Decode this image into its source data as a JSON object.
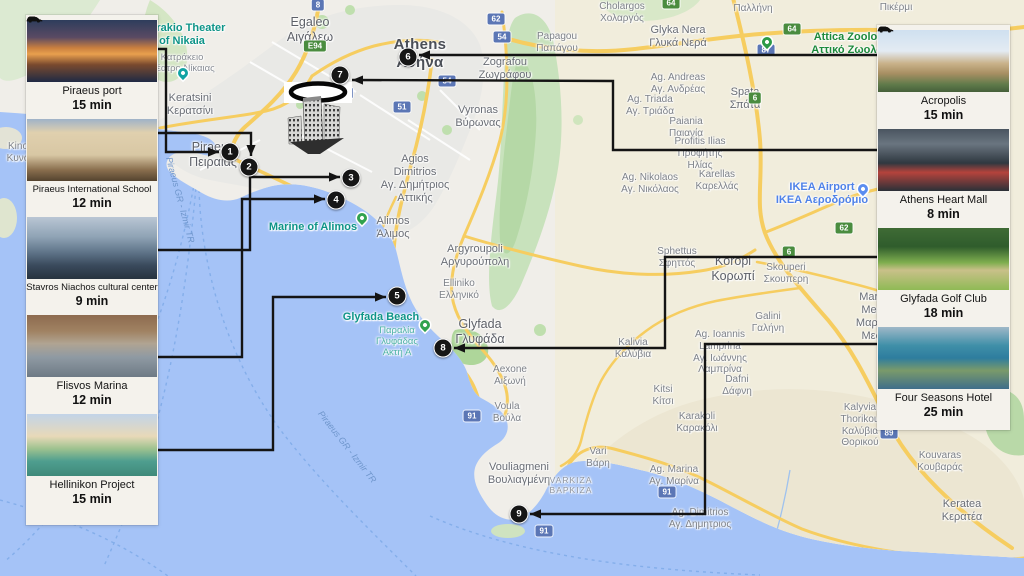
{
  "accent_colors": {
    "sea": "#a5c3f7",
    "land": "#f0eee9",
    "marker_bg": "#161616",
    "badge_blue": "#5b76b5",
    "badge_green": "#4a8c3f",
    "poi_teal": "#0e9488",
    "poi_green": "#1d8a3c",
    "poi_blue": "#4f82e8",
    "connector": "#141414"
  },
  "left_panel": {
    "items": [
      {
        "title": "Piraeus port",
        "time": "15 min",
        "img": "port"
      },
      {
        "title": "Piraeus International School",
        "time": "12 min",
        "img": "school"
      },
      {
        "title": "Stavros Niachos cultural center",
        "time": "9 min",
        "img": "stavros"
      },
      {
        "title": "Flisvos Marina",
        "time": "12 min",
        "img": "flisvos"
      },
      {
        "title": "Hellinikon Project",
        "time": "15 min",
        "img": "hellinikon"
      }
    ]
  },
  "right_panel": {
    "items": [
      {
        "title": "Acropolis",
        "time": "15 min",
        "img": "acropolis"
      },
      {
        "title": "Athens Heart Mall",
        "time": "8 min",
        "img": "mall"
      },
      {
        "title": "Glyfada Golf Club",
        "time": "18 min",
        "img": "golf"
      },
      {
        "title": "Four Seasons Hotel",
        "time": "25 min",
        "img": "fourseasons"
      }
    ]
  },
  "map": {
    "labels": [
      {
        "x": 310,
        "y": 15,
        "s": "md",
        "lines": [
          "Egaleo",
          "Αιγάλεω"
        ]
      },
      {
        "x": 420,
        "y": 36,
        "s": "lg",
        "lines": [
          "Athens",
          "Αθήνα"
        ]
      },
      {
        "x": 190,
        "y": 92,
        "s": "sm",
        "lines": [
          "Keratsini",
          "Κερατσίνι"
        ]
      },
      {
        "x": 213,
        "y": 140,
        "s": "md",
        "lines": [
          "Piraeus",
          "Πειραιάς"
        ]
      },
      {
        "x": 478,
        "y": 104,
        "s": "sm",
        "lines": [
          "Vyronas",
          "Βύρωνας"
        ]
      },
      {
        "x": 505,
        "y": 56,
        "s": "sm",
        "lines": [
          "Zografou",
          "Ζωγράφου"
        ]
      },
      {
        "x": 557,
        "y": 31,
        "s": "xs",
        "lines": [
          "Papagou",
          "Παπάγου"
        ]
      },
      {
        "x": 622,
        "y": 1,
        "s": "xs",
        "lines": [
          "Cholargos",
          "Χολαργός"
        ]
      },
      {
        "x": 678,
        "y": 24,
        "s": "sm",
        "lines": [
          "Glyka Nera",
          "Γλυκά Νερά"
        ]
      },
      {
        "x": 753,
        "y": 3,
        "s": "xs",
        "lines": [
          "Παλλήνη"
        ]
      },
      {
        "x": 896,
        "y": 2,
        "s": "xs",
        "lines": [
          "Πικέρμι"
        ]
      },
      {
        "x": 745,
        "y": 86,
        "s": "sm",
        "lines": [
          "Spata",
          "Σπάτα"
        ]
      },
      {
        "x": 678,
        "y": 72,
        "s": "xs",
        "lines": [
          "Ag. Andreas",
          "Αγ. Ανδρέας"
        ]
      },
      {
        "x": 650,
        "y": 94,
        "s": "xs",
        "lines": [
          "Ag. Triada",
          "Αγ. Τριάδα"
        ]
      },
      {
        "x": 686,
        "y": 116,
        "s": "xs",
        "lines": [
          "Paiania",
          "Παιανία"
        ]
      },
      {
        "x": 700,
        "y": 136,
        "s": "xs",
        "lines": [
          "Profitis Ilias",
          "Προφήτης",
          "Ηλίας"
        ]
      },
      {
        "x": 650,
        "y": 172,
        "s": "xs",
        "lines": [
          "Ag. Nikolaos",
          "Αγ. Νικόλαος"
        ]
      },
      {
        "x": 717,
        "y": 169,
        "s": "xs",
        "lines": [
          "Karellas",
          "Καρελλάς"
        ]
      },
      {
        "x": 415,
        "y": 153,
        "s": "sm",
        "lines": [
          "Agios",
          "Dimitrios",
          "Αγ. Δημήτριος",
          "Αττικής"
        ]
      },
      {
        "x": 393,
        "y": 215,
        "s": "sm",
        "lines": [
          "Alimos",
          "Άλιμος"
        ]
      },
      {
        "x": 475,
        "y": 243,
        "s": "sm",
        "lines": [
          "Argyroupoli",
          "Αργυρούπολη"
        ]
      },
      {
        "x": 459,
        "y": 278,
        "s": "xs",
        "lines": [
          "Elliniko",
          "Ελληνικό"
        ]
      },
      {
        "x": 480,
        "y": 317,
        "s": "md",
        "lines": [
          "Glyfada",
          "Γλυφάδα"
        ]
      },
      {
        "x": 510,
        "y": 364,
        "s": "xs",
        "lines": [
          "Aexone",
          "Αιξωνή"
        ]
      },
      {
        "x": 507,
        "y": 401,
        "s": "xs",
        "lines": [
          "Voula",
          "Βούλα"
        ]
      },
      {
        "x": 519,
        "y": 461,
        "s": "sm",
        "lines": [
          "Vouliagmeni",
          "Βουλιαγμένη"
        ]
      },
      {
        "x": 571,
        "y": 475,
        "s": "tiny",
        "lines": [
          "VARKIZA",
          "ΒΑΡΚΙΖΑ"
        ]
      },
      {
        "x": 598,
        "y": 446,
        "s": "xs",
        "lines": [
          "Vari",
          "Βάρη"
        ]
      },
      {
        "x": 674,
        "y": 464,
        "s": "xs",
        "lines": [
          "Ag. Marina",
          "Αγ. Μαρίνα"
        ]
      },
      {
        "x": 700,
        "y": 507,
        "s": "xs",
        "lines": [
          "Ag. Dimitrios",
          "Αγ. Δημητριος"
        ]
      },
      {
        "x": 697,
        "y": 411,
        "s": "xs",
        "lines": [
          "Karakoli",
          "Καρακόλι"
        ]
      },
      {
        "x": 663,
        "y": 384,
        "s": "xs",
        "lines": [
          "Kitsi",
          "Κίτσι"
        ]
      },
      {
        "x": 737,
        "y": 374,
        "s": "xs",
        "lines": [
          "Dafni",
          "Δάφνη"
        ]
      },
      {
        "x": 677,
        "y": 246,
        "s": "xs",
        "lines": [
          "Sphettus",
          "Σφηττός"
        ]
      },
      {
        "x": 733,
        "y": 254,
        "s": "md",
        "lines": [
          "Koropi",
          "Κορωπί"
        ]
      },
      {
        "x": 786,
        "y": 262,
        "s": "xs",
        "lines": [
          "Skouperi",
          "Σκουπερη"
        ]
      },
      {
        "x": 768,
        "y": 311,
        "s": "xs",
        "lines": [
          "Galini",
          "Γαλήνη"
        ]
      },
      {
        "x": 720,
        "y": 329,
        "s": "xs",
        "lines": [
          "Ag. Ioannis",
          "Lamprina",
          "Αγ. Ιωάννης",
          "Λαμπρίνα"
        ]
      },
      {
        "x": 888,
        "y": 291,
        "s": "sm",
        "lines": [
          "Markopoulo",
          "Mesogaias",
          "Μαρκόπουλο",
          "Μεσογαίας"
        ]
      },
      {
        "x": 860,
        "y": 402,
        "s": "xs",
        "lines": [
          "Kalyvia",
          "Thorikou",
          "Καλύβια",
          "Θορικού"
        ]
      },
      {
        "x": 940,
        "y": 450,
        "s": "xs",
        "lines": [
          "Kouvaras",
          "Κουβαράς"
        ]
      },
      {
        "x": 962,
        "y": 498,
        "s": "sm",
        "lines": [
          "Keratea",
          "Κερατέα"
        ]
      },
      {
        "x": 633,
        "y": 337,
        "s": "xs",
        "lines": [
          "Kalivia",
          "Καλύβια"
        ]
      },
      {
        "x": 18,
        "y": 141,
        "s": "xs",
        "lines": [
          "Kino",
          "Κυνό"
        ]
      }
    ],
    "pois": [
      {
        "x": 182,
        "y": 22,
        "s": "teal",
        "lines": [
          "Katrakio Theater",
          "of Nikaia"
        ]
      },
      {
        "x": 182,
        "y": 52,
        "s": "gray-poi",
        "lines": [
          "Κατράκειο",
          "Θέατρο Νίκαιας"
        ]
      },
      {
        "x": 313,
        "y": 221,
        "s": "teal",
        "lines": [
          "Marine of Alimos"
        ]
      },
      {
        "x": 381,
        "y": 311,
        "s": "teal",
        "lines": [
          "Glyfada Beach"
        ]
      },
      {
        "x": 397,
        "y": 325,
        "s": "teal2",
        "lines": [
          "Παραλία",
          "Γλυφάδας",
          "Ακτή Α"
        ]
      },
      {
        "x": 858,
        "y": 31,
        "s": "green",
        "lines": [
          "Attica Zoological",
          "Αττικό Ζωολογικό"
        ]
      },
      {
        "x": 822,
        "y": 181,
        "s": "blue",
        "lines": [
          "IKEA Airport",
          "ΙΚΕΑ Αεροδρόμιο"
        ]
      }
    ],
    "pins": [
      {
        "x": 183,
        "y": 78,
        "c": "#11a3a3",
        "name": "theater-pin-icon"
      },
      {
        "x": 362,
        "y": 223,
        "c": "#30a24e",
        "name": "marina-pin-icon"
      },
      {
        "x": 425,
        "y": 330,
        "c": "#30a24e",
        "name": "beach-pin-icon"
      },
      {
        "x": 767,
        "y": 47,
        "c": "#2c9a46",
        "name": "zoo-pin-icon"
      },
      {
        "x": 863,
        "y": 194,
        "c": "#5b8df0",
        "name": "ikea-pin-icon"
      }
    ],
    "water_labels": [
      {
        "x": 180,
        "y": 200,
        "a": 75,
        "t": "Piraeus GR - Izmir TR"
      },
      {
        "x": 347,
        "y": 447,
        "a": 52,
        "t": "Piraeus GR - Izmir TR"
      }
    ],
    "badges": [
      {
        "t": "8",
        "c": "blue",
        "x": 318,
        "y": 5
      },
      {
        "t": "E94",
        "c": "green",
        "x": 315,
        "y": 46
      },
      {
        "t": "9",
        "c": "blue",
        "x": 347,
        "y": 93
      },
      {
        "t": "51",
        "c": "blue",
        "x": 402,
        "y": 107
      },
      {
        "t": "62",
        "c": "blue",
        "x": 496,
        "y": 19
      },
      {
        "t": "54",
        "c": "blue",
        "x": 502,
        "y": 37
      },
      {
        "t": "54",
        "c": "blue",
        "x": 447,
        "y": 81
      },
      {
        "t": "87",
        "c": "blue",
        "x": 766,
        "y": 50
      },
      {
        "t": "64",
        "c": "green",
        "x": 671,
        "y": 3
      },
      {
        "t": "64",
        "c": "green",
        "x": 792,
        "y": 29
      },
      {
        "t": "6",
        "c": "green",
        "x": 755,
        "y": 98
      },
      {
        "t": "6",
        "c": "green",
        "x": 789,
        "y": 252
      },
      {
        "t": "62",
        "c": "green",
        "x": 844,
        "y": 228
      },
      {
        "t": "91",
        "c": "blue",
        "x": 472,
        "y": 416
      },
      {
        "t": "91",
        "c": "blue",
        "x": 667,
        "y": 492
      },
      {
        "t": "91",
        "c": "blue",
        "x": 544,
        "y": 531
      },
      {
        "t": "89",
        "c": "blue",
        "x": 889,
        "y": 433
      }
    ],
    "markers": [
      {
        "n": "1",
        "x": 230,
        "y": 152
      },
      {
        "n": "2",
        "x": 249,
        "y": 167
      },
      {
        "n": "3",
        "x": 351,
        "y": 178
      },
      {
        "n": "4",
        "x": 336,
        "y": 200
      },
      {
        "n": "5",
        "x": 397,
        "y": 296
      },
      {
        "n": "6",
        "x": 408,
        "y": 57
      },
      {
        "n": "7",
        "x": 340,
        "y": 75
      },
      {
        "n": "8",
        "x": 443,
        "y": 348
      },
      {
        "n": "9",
        "x": 519,
        "y": 514
      }
    ],
    "connectors": [
      {
        "points": [
          [
            158,
            49
          ],
          [
            166,
            49
          ],
          [
            166,
            152
          ],
          [
            219,
            152
          ]
        ]
      },
      {
        "points": [
          [
            158,
            133
          ],
          [
            251,
            133
          ],
          [
            251,
            156
          ]
        ]
      },
      {
        "points": [
          [
            158,
            250
          ],
          [
            250,
            250
          ],
          [
            250,
            177
          ],
          [
            340,
            177
          ]
        ]
      },
      {
        "points": [
          [
            158,
            357
          ],
          [
            242,
            357
          ],
          [
            242,
            199
          ],
          [
            325,
            199
          ]
        ]
      },
      {
        "points": [
          [
            158,
            450
          ],
          [
            273,
            450
          ],
          [
            273,
            297
          ],
          [
            386,
            297
          ]
        ]
      },
      {
        "points": [
          [
            877,
            55
          ],
          [
            419,
            55
          ]
        ]
      },
      {
        "points": [
          [
            877,
            150
          ],
          [
            613,
            150
          ],
          [
            613,
            81
          ],
          [
            352,
            80
          ]
        ]
      },
      {
        "points": [
          [
            877,
            257
          ],
          [
            665,
            257
          ],
          [
            665,
            348
          ],
          [
            454,
            348
          ]
        ]
      },
      {
        "points": [
          [
            877,
            344
          ],
          [
            705,
            344
          ],
          [
            705,
            514
          ],
          [
            530,
            514
          ]
        ]
      }
    ]
  }
}
